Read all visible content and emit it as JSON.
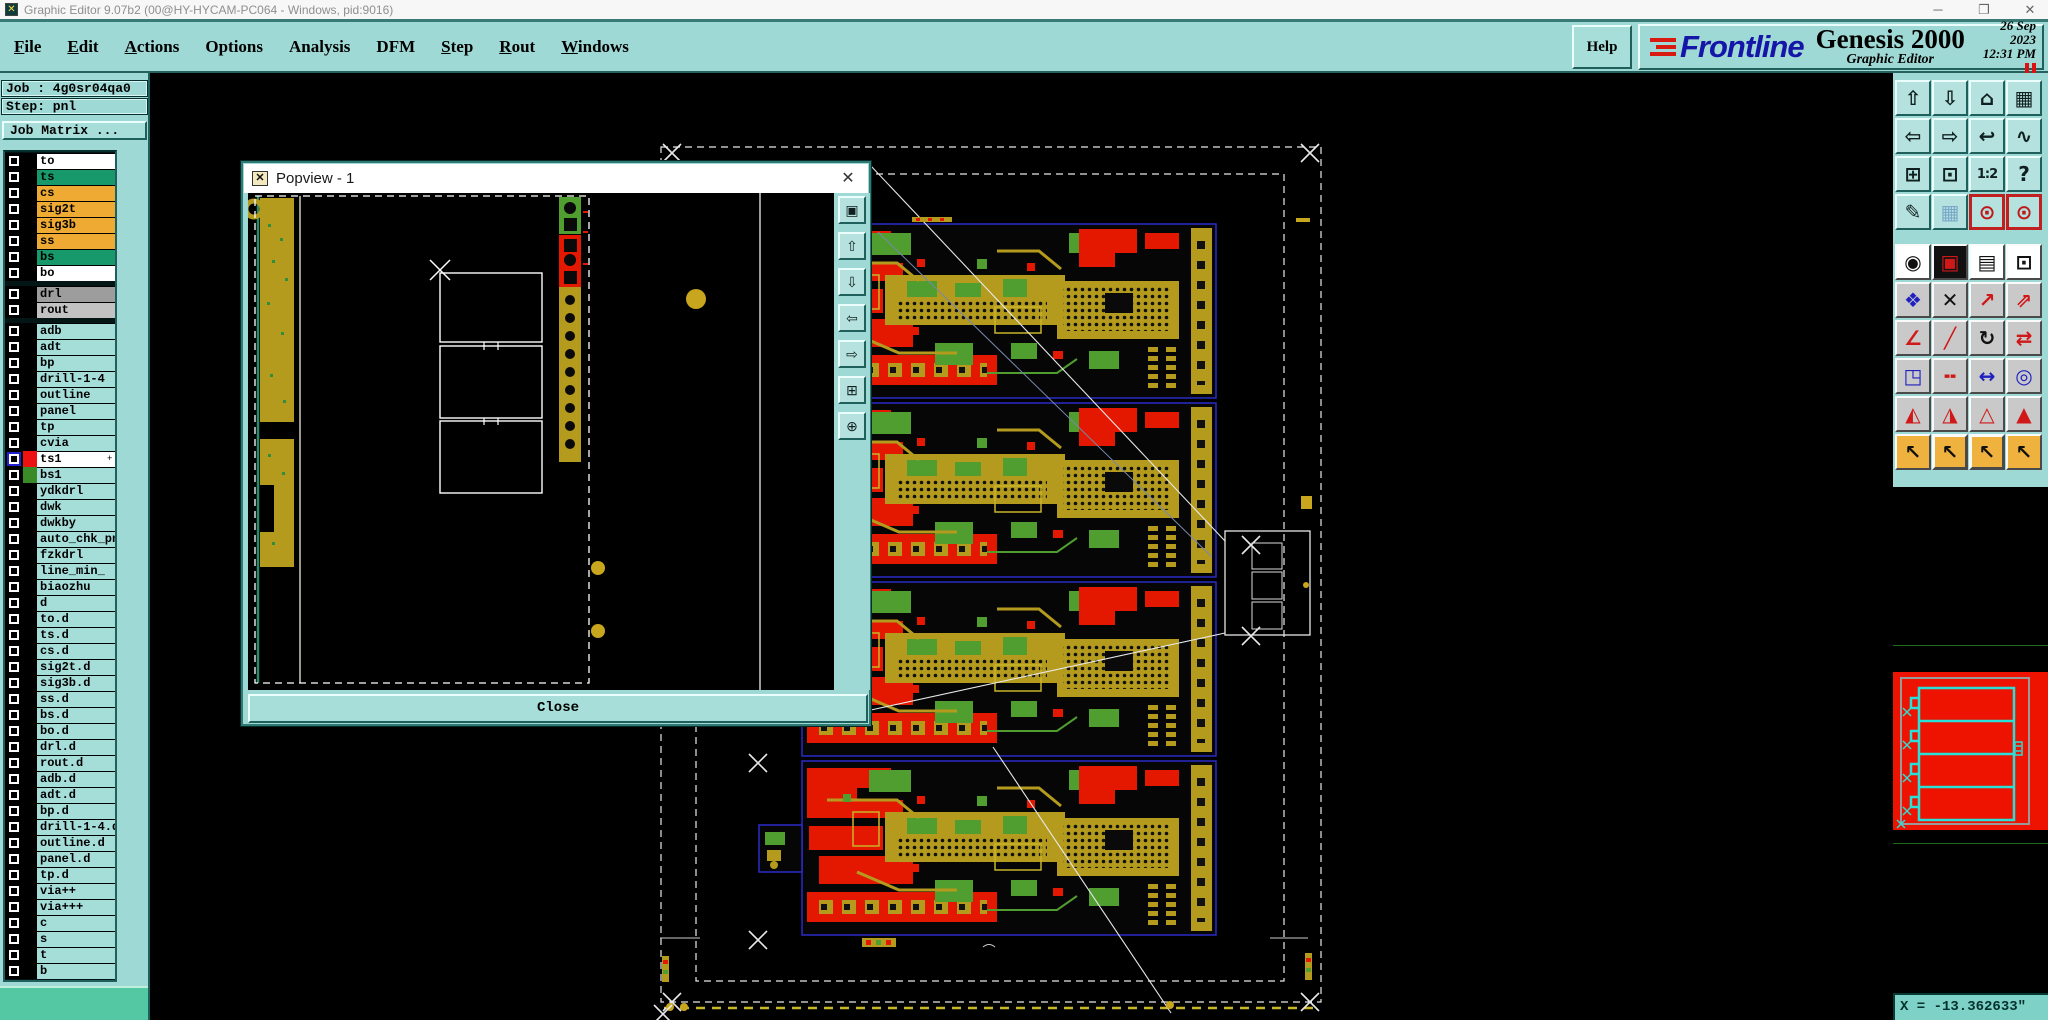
{
  "window": {
    "title": "Graphic Editor 9.07b2 (00@HY-HYCAM-PC064 - Windows, pid:9016)",
    "app_icon_glyph": "✕",
    "controls": [
      {
        "n": "minimize-icon",
        "g": "─"
      },
      {
        "n": "maximize-icon",
        "g": "❐"
      },
      {
        "n": "close-icon",
        "g": "✕"
      }
    ]
  },
  "menubar": {
    "items": [
      {
        "label": "File",
        "u": true
      },
      {
        "label": "Edit",
        "u": true
      },
      {
        "label": "Actions",
        "u": true
      },
      {
        "label": "Options",
        "u": false
      },
      {
        "label": "Analysis",
        "u": false
      },
      {
        "label": "DFM",
        "u": false
      },
      {
        "label": "Step",
        "u": true
      },
      {
        "label": "Rout",
        "u": true
      },
      {
        "label": "Windows",
        "u": true
      }
    ],
    "help_label": "Help"
  },
  "brand": {
    "logo_text": "Frontline",
    "product": "Genesis 2000",
    "subtitle": "Graphic Editor",
    "date": "26 Sep 2023",
    "time": "12:31 PM"
  },
  "sidebar": {
    "job_label": "Job : 4g0sr04qa0",
    "step_label": "Step: pnl",
    "job_matrix_label": "Job Matrix ...",
    "layers": [
      {
        "label": "to",
        "bg": "#ffffff"
      },
      {
        "label": "ts",
        "bg": "#18996b"
      },
      {
        "label": "cs",
        "bg": "#eeaa33"
      },
      {
        "label": "sig2t",
        "bg": "#eeaa33"
      },
      {
        "label": "sig3b",
        "bg": "#eeaa33"
      },
      {
        "label": "ss",
        "bg": "#eeaa33"
      },
      {
        "label": "bs",
        "bg": "#18996b"
      },
      {
        "label": "bo",
        "bg": "#ffffff"
      },
      {
        "label": "drl",
        "bg": "#9d9d9d",
        "brk": true
      },
      {
        "label": "rout",
        "bg": "#c2c2c2"
      },
      {
        "label": "adb",
        "bg": "#a5ddd9",
        "brk": true
      },
      {
        "label": "adt",
        "bg": "#a5ddd9"
      },
      {
        "label": "bp",
        "bg": "#a5ddd9"
      },
      {
        "label": "drill-1-4",
        "bg": "#a5ddd9"
      },
      {
        "label": "outline",
        "bg": "#a5ddd9"
      },
      {
        "label": "panel",
        "bg": "#a5ddd9"
      },
      {
        "label": "tp",
        "bg": "#a5ddd9"
      },
      {
        "label": "cvia",
        "bg": "#a5ddd9"
      },
      {
        "label": "ts1",
        "bg": "#ffffff",
        "sw": "#ee1111",
        "sel": true,
        "mark": "+"
      },
      {
        "label": "bs1",
        "bg": "#a5ddd9",
        "sw": "#3a8a28"
      },
      {
        "label": "ydkdrl",
        "bg": "#a5ddd9"
      },
      {
        "label": "dwk",
        "bg": "#a5ddd9"
      },
      {
        "label": "dwkby",
        "bg": "#a5ddd9"
      },
      {
        "label": "auto_chk_pn",
        "bg": "#a5ddd9"
      },
      {
        "label": "fzkdrl",
        "bg": "#a5ddd9"
      },
      {
        "label": "line_min_",
        "bg": "#a5ddd9"
      },
      {
        "label": "biaozhu",
        "bg": "#a5ddd9"
      },
      {
        "label": "d",
        "bg": "#a5ddd9"
      },
      {
        "label": "to.d",
        "bg": "#a5ddd9"
      },
      {
        "label": "ts.d",
        "bg": "#a5ddd9"
      },
      {
        "label": "cs.d",
        "bg": "#a5ddd9"
      },
      {
        "label": "sig2t.d",
        "bg": "#a5ddd9"
      },
      {
        "label": "sig3b.d",
        "bg": "#a5ddd9"
      },
      {
        "label": "ss.d",
        "bg": "#a5ddd9"
      },
      {
        "label": "bs.d",
        "bg": "#a5ddd9"
      },
      {
        "label": "bo.d",
        "bg": "#a5ddd9"
      },
      {
        "label": "drl.d",
        "bg": "#a5ddd9"
      },
      {
        "label": "rout.d",
        "bg": "#a5ddd9"
      },
      {
        "label": "adb.d",
        "bg": "#a5ddd9"
      },
      {
        "label": "adt.d",
        "bg": "#a5ddd9"
      },
      {
        "label": "bp.d",
        "bg": "#a5ddd9"
      },
      {
        "label": "drill-1-4.d",
        "bg": "#a5ddd9"
      },
      {
        "label": "outline.d",
        "bg": "#a5ddd9"
      },
      {
        "label": "panel.d",
        "bg": "#a5ddd9"
      },
      {
        "label": "tp.d",
        "bg": "#a5ddd9"
      },
      {
        "label": "via++",
        "bg": "#a5ddd9"
      },
      {
        "label": "via+++",
        "bg": "#a5ddd9"
      },
      {
        "label": "c",
        "bg": "#a5ddd9"
      },
      {
        "label": "s",
        "bg": "#a5ddd9"
      },
      {
        "label": "t",
        "bg": "#a5ddd9"
      },
      {
        "label": "b",
        "bg": "#a5ddd9"
      }
    ]
  },
  "popview": {
    "title": "Popview - 1",
    "close_icon": "✕",
    "icon_glyph": "✕",
    "close_label": "Close",
    "tools": [
      {
        "n": "popout-window-icon",
        "g": "▣"
      },
      {
        "n": "pan-up-icon",
        "g": "⇧"
      },
      {
        "n": "pan-down-icon",
        "g": "⇩"
      },
      {
        "n": "pan-left-icon",
        "g": "⇦"
      },
      {
        "n": "pan-right-icon",
        "g": "⇨"
      },
      {
        "n": "zoom-fit-icon",
        "g": "⊞"
      },
      {
        "n": "zoom-target-icon",
        "g": "⊕"
      }
    ]
  },
  "toolbar": {
    "view_buttons": [
      {
        "n": "pan-up-icon",
        "g": "⇧",
        "bg": "#b5e2de",
        "fg": "#102020"
      },
      {
        "n": "pan-down-icon",
        "g": "⇩",
        "bg": "#b5e2de",
        "fg": "#102020"
      },
      {
        "n": "home-view-icon",
        "g": "⌂",
        "bg": "#b5e2de",
        "fg": "#102020"
      },
      {
        "n": "window-xy-icon",
        "g": "▦",
        "bg": "#b5e2de",
        "fg": "#102020"
      },
      {
        "n": "pan-left-icon",
        "g": "⇦",
        "bg": "#b5e2de",
        "fg": "#102020"
      },
      {
        "n": "pan-right-icon",
        "g": "⇨",
        "bg": "#b5e2de",
        "fg": "#102020"
      },
      {
        "n": "previous-view-icon",
        "g": "↩",
        "bg": "#b5e2de",
        "fg": "#102020"
      },
      {
        "n": "scroll-path-icon",
        "g": "∿",
        "bg": "#b5e2de",
        "fg": "#102020"
      },
      {
        "n": "zoom-extents-icon",
        "g": "⊞",
        "bg": "#b5e2de",
        "fg": "#102020"
      },
      {
        "n": "zoom-center-icon",
        "g": "⊡",
        "bg": "#b5e2de",
        "fg": "#102020"
      },
      {
        "n": "zoom-ratio-icon",
        "g": "1:2",
        "bg": "#b5e2de",
        "fg": "#102020",
        "small": true
      },
      {
        "n": "query-help-icon",
        "g": "?",
        "bg": "#b5e2de",
        "fg": "#102020"
      },
      {
        "n": "setup-tools-icon",
        "g": "✎",
        "bg": "#b5e2de",
        "fg": "#102020"
      },
      {
        "n": "grid-toggle-icon",
        "g": "▦",
        "bg": "#b5e2de",
        "fg": "#7aa8c8"
      },
      {
        "n": "via-display-a-icon",
        "g": "⊙",
        "bg": "#b5e2de",
        "fg": "#c01818",
        "fr": true
      },
      {
        "n": "via-display-b-icon",
        "g": "⊙",
        "bg": "#b5e2de",
        "fg": "#c01818",
        "fr": true
      }
    ],
    "edit_buttons": [
      {
        "n": "transform-select-icon",
        "g": "◉",
        "bg": "#ffffff",
        "fg": "#111111"
      },
      {
        "n": "layer-compare-icon",
        "g": "▣",
        "bg": "#111111",
        "fg": "#d01818"
      },
      {
        "n": "ruler-measure-icon",
        "g": "▤",
        "bg": "#ffffff",
        "fg": "#111111"
      },
      {
        "n": "pad-capture-icon",
        "g": "⊡",
        "bg": "#ffffff",
        "fg": "#111111"
      },
      {
        "n": "net-chain-icon",
        "g": "❖",
        "bg": "#c9c9c9",
        "fg": "#2020c0"
      },
      {
        "n": "deselect-icon",
        "g": "✕",
        "bg": "#c9c9c9",
        "fg": "#111111"
      },
      {
        "n": "copy-to-icon",
        "g": "↗",
        "bg": "#c9c9c9",
        "fg": "#d01818"
      },
      {
        "n": "move-to-icon",
        "g": "⇗",
        "bg": "#c9c9c9",
        "fg": "#d01818"
      },
      {
        "n": "line-angle-icon",
        "g": "∠",
        "bg": "#c9c9c9",
        "fg": "#d01818"
      },
      {
        "n": "line-slant-icon",
        "g": "╱",
        "bg": "#c9c9c9",
        "fg": "#d01818"
      },
      {
        "n": "rotate-icon",
        "g": "↻",
        "bg": "#c9c9c9",
        "fg": "#111111"
      },
      {
        "n": "mirror-icon",
        "g": "⇄",
        "bg": "#c9c9c9",
        "fg": "#d01818"
      },
      {
        "n": "swap-origin-icon",
        "g": "◳",
        "bg": "#c9c9c9",
        "fg": "#2020c0"
      },
      {
        "n": "break-line-icon",
        "g": "╍",
        "bg": "#c9c9c9",
        "fg": "#d01818"
      },
      {
        "n": "measure-distance-icon",
        "g": "↔",
        "bg": "#c9c9c9",
        "fg": "#2020c0"
      },
      {
        "n": "surface-circles-icon",
        "g": "◎",
        "bg": "#c9c9c9",
        "fg": "#2020c0"
      },
      {
        "n": "arc-peak-a-icon",
        "g": "◭",
        "bg": "#c9c9c9",
        "fg": "#d01818"
      },
      {
        "n": "arc-peak-b-icon",
        "g": "◮",
        "bg": "#c9c9c9",
        "fg": "#d01818"
      },
      {
        "n": "arc-peak-c-icon",
        "g": "△",
        "bg": "#c9c9c9",
        "fg": "#d01818"
      },
      {
        "n": "arc-peak-d-icon",
        "g": "▲",
        "bg": "#c9c9c9",
        "fg": "#d01818"
      },
      {
        "n": "cursor-select-icon",
        "g": "↖",
        "bg": "#f0b23e",
        "fg": "#111111"
      },
      {
        "n": "frame-select-icon",
        "g": "↖",
        "bg": "#f0b23e",
        "fg": "#111111",
        "fr": true
      },
      {
        "n": "poly-select-icon",
        "g": "↖",
        "bg": "#f0b23e",
        "fg": "#111111",
        "fr": true
      },
      {
        "n": "net-cursor-icon",
        "g": "↖",
        "bg": "#f0b23e",
        "fg": "#111111"
      }
    ]
  },
  "status": {
    "x_readout": "X = -13.362633\""
  },
  "colors": {
    "panel_teal": "#9fd9d5",
    "pcb_red": "#e41800",
    "pcb_olive": "#b49b1e",
    "pcb_green": "#4f9e2f",
    "overview_red": "#ee1200",
    "overview_cyan": "#28e0d8",
    "active_frame_red": "#c02020",
    "selected_checkbox_blue": "#2121cf"
  }
}
